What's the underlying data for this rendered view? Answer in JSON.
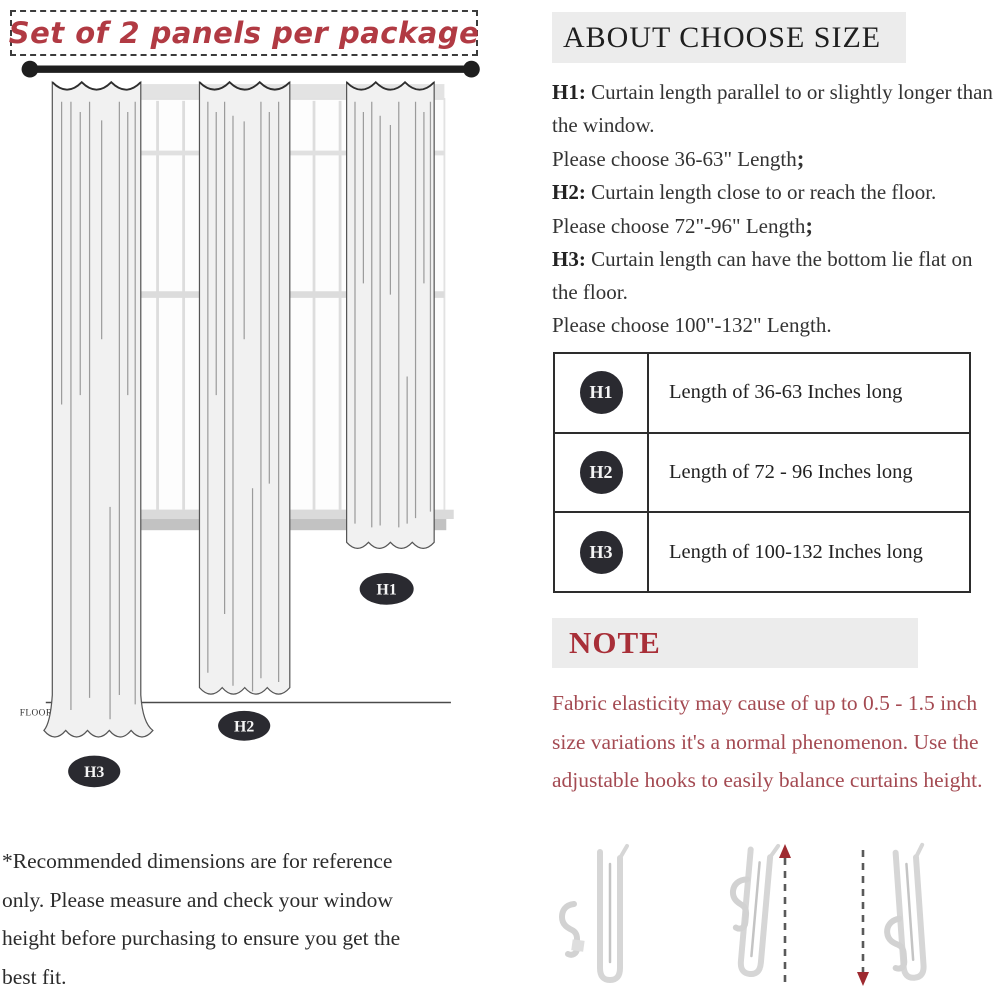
{
  "colors": {
    "banner_red": "#b13a43",
    "note_heading_red": "#a82f38",
    "note_body_red": "#a44a52",
    "heading_bg": "#ececec",
    "badge_dark": "#2a2a30",
    "curtain_fill": "#f1f1f1",
    "rod_black": "#1e1e1e",
    "arrow_red": "#9e2a30"
  },
  "left": {
    "banner": "Set of 2 panels per package",
    "floor_label": "FLOOR",
    "curtain_labels": [
      "H1",
      "H2",
      "H3"
    ],
    "disclaimer": "*Recommended dimensions are for reference only. Please measure and check your window height before purchasing to ensure you get the best fit."
  },
  "right": {
    "heading": "ABOUT CHOOSE SIZE",
    "size_guide": [
      {
        "label": "H1:",
        "desc": " Curtain length parallel to or slightly longer than the window.",
        "choose": "Please choose 36-63\" Length",
        "punct": ";"
      },
      {
        "label": "H2:",
        "desc": " Curtain length close to or reach the floor.",
        "choose": "Please choose 72\"-96\" Length",
        "punct": ";"
      },
      {
        "label": "H3:",
        "desc": " Curtain length can have the bottom lie flat on the floor.",
        "choose": "Please choose 100\"-132\" Length",
        "punct": "."
      }
    ],
    "table": {
      "rows": [
        {
          "badge": "H1",
          "text": "Length of 36-63 Inches long"
        },
        {
          "badge": "H2",
          "text": "Length of 72 - 96 Inches long"
        },
        {
          "badge": "H3",
          "text": "Length of 100-132 Inches long"
        }
      ]
    },
    "note": {
      "heading": "NOTE",
      "body": "Fabric elasticity may cause of up to 0.5 - 1.5 inch size variations it's a normal phenomenon. Use the adjustable hooks to easily balance curtains height."
    }
  }
}
